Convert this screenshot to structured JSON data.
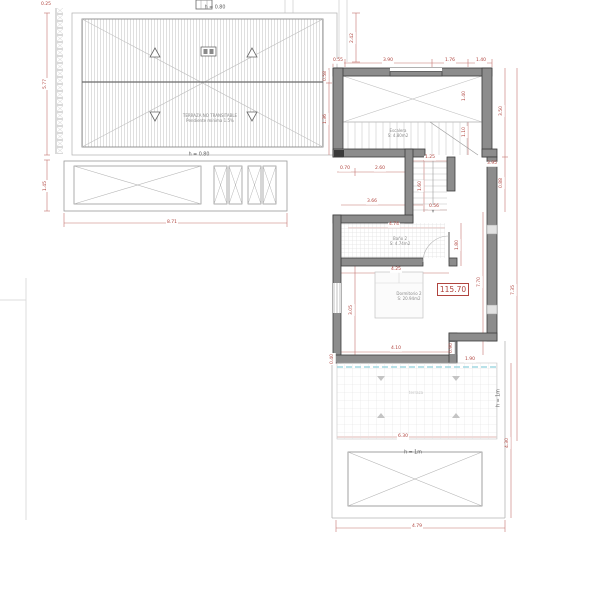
{
  "drawing": {
    "type": "architectural-floor-plan",
    "level_badge": "115.70"
  },
  "colors": {
    "dimension_red": "#b0443e",
    "wall_gray": "#8c8c8c",
    "wall_edge": "#3c3c3c",
    "hatch_gray": "#c9c9c9",
    "dashed_cyan": "#8fd0dc"
  },
  "dimensions": [
    {
      "t": "0.25",
      "x": 46,
      "y": 5,
      "r": 0
    },
    {
      "t": "5.77",
      "x": 46,
      "y": 84,
      "r": -90
    },
    {
      "t": "1.45",
      "x": 46,
      "y": 186,
      "r": -90
    },
    {
      "t": "8.71",
      "x": 172,
      "y": 223,
      "r": 0
    },
    {
      "t": "2.42",
      "x": 353,
      "y": 38,
      "r": -90
    },
    {
      "t": "0.55",
      "x": 338,
      "y": 61,
      "r": 0
    },
    {
      "t": "3.90",
      "x": 388,
      "y": 61,
      "r": 0
    },
    {
      "t": "1.76",
      "x": 450,
      "y": 61,
      "r": 0
    },
    {
      "t": "1.40",
      "x": 481,
      "y": 61,
      "r": 0
    },
    {
      "t": "0.58",
      "x": 326,
      "y": 76,
      "r": -90
    },
    {
      "t": "1.36",
      "x": 326,
      "y": 119,
      "r": -90
    },
    {
      "t": "1.40",
      "x": 465,
      "y": 96,
      "r": -90
    },
    {
      "t": "1.10",
      "x": 465,
      "y": 132,
      "r": -90
    },
    {
      "t": "3.50",
      "x": 502,
      "y": 111,
      "r": -90
    },
    {
      "t": "0.88",
      "x": 502,
      "y": 183,
      "r": -90
    },
    {
      "t": "7.70",
      "x": 480,
      "y": 282,
      "r": -90
    },
    {
      "t": "7.35",
      "x": 514,
      "y": 290,
      "r": -90
    },
    {
      "t": "0.70",
      "x": 345,
      "y": 169,
      "r": 0
    },
    {
      "t": "2.60",
      "x": 380,
      "y": 169,
      "r": 0
    },
    {
      "t": "1.25",
      "x": 430,
      "y": 158,
      "r": 0
    },
    {
      "t": "3.95",
      "x": 492,
      "y": 164,
      "r": 0
    },
    {
      "t": "1.60",
      "x": 421,
      "y": 186,
      "r": -90
    },
    {
      "t": "3.66",
      "x": 372,
      "y": 202,
      "r": 0
    },
    {
      "t": "0.56",
      "x": 434,
      "y": 207,
      "r": 0
    },
    {
      "t": "4.74",
      "x": 394,
      "y": 225,
      "r": 0
    },
    {
      "t": "1.80",
      "x": 458,
      "y": 245,
      "r": -90
    },
    {
      "t": "4.25",
      "x": 396,
      "y": 270,
      "r": 0
    },
    {
      "t": "3.05",
      "x": 352,
      "y": 310,
      "r": -90
    },
    {
      "t": "4.10",
      "x": 396,
      "y": 349,
      "r": 0
    },
    {
      "t": "0.90",
      "x": 452,
      "y": 348,
      "r": -90
    },
    {
      "t": "0.40",
      "x": 333,
      "y": 359,
      "r": -90
    },
    {
      "t": "1.90",
      "x": 470,
      "y": 360,
      "r": 0
    },
    {
      "t": "6.30",
      "x": 403,
      "y": 437,
      "r": 0
    },
    {
      "t": "4.30",
      "x": 508,
      "y": 443,
      "r": -90
    },
    {
      "t": "4.79",
      "x": 417,
      "y": 527,
      "r": 0
    }
  ],
  "annotations": [
    {
      "t": "h = 0.80",
      "x": 215,
      "y": 9,
      "r": 0,
      "cls": "dark"
    },
    {
      "t": "h = 0.80",
      "x": 199,
      "y": 156,
      "r": 0,
      "cls": "dark"
    },
    {
      "t": "h = 1m",
      "x": 413,
      "y": 454,
      "r": 0,
      "cls": "dark"
    },
    {
      "t": "h = 1m",
      "x": 500,
      "y": 398,
      "r": -90,
      "cls": "dark"
    },
    {
      "t": "TERRAZA NO TRANSITABLE",
      "x": 210,
      "y": 116,
      "r": 0,
      "cls": ""
    },
    {
      "t": "Pendiente mínima 1.5%",
      "x": 210,
      "y": 121,
      "r": 0,
      "cls": ""
    },
    {
      "t": "Escalera",
      "x": 398,
      "y": 131,
      "r": 0,
      "cls": ""
    },
    {
      "t": "S: 4.80m2",
      "x": 398,
      "y": 136,
      "r": 0,
      "cls": ""
    },
    {
      "t": "Baño 2",
      "x": 400,
      "y": 239,
      "r": 0,
      "cls": ""
    },
    {
      "t": "S: 4.74m2",
      "x": 400,
      "y": 244,
      "r": 0,
      "cls": ""
    },
    {
      "t": "Dormitorio 2",
      "x": 409,
      "y": 294,
      "r": 0,
      "cls": ""
    },
    {
      "t": "S: 20.94m2",
      "x": 409,
      "y": 299,
      "r": 0,
      "cls": ""
    },
    {
      "t": "terraza",
      "x": 416,
      "y": 393,
      "r": 0,
      "cls": "faint"
    }
  ]
}
